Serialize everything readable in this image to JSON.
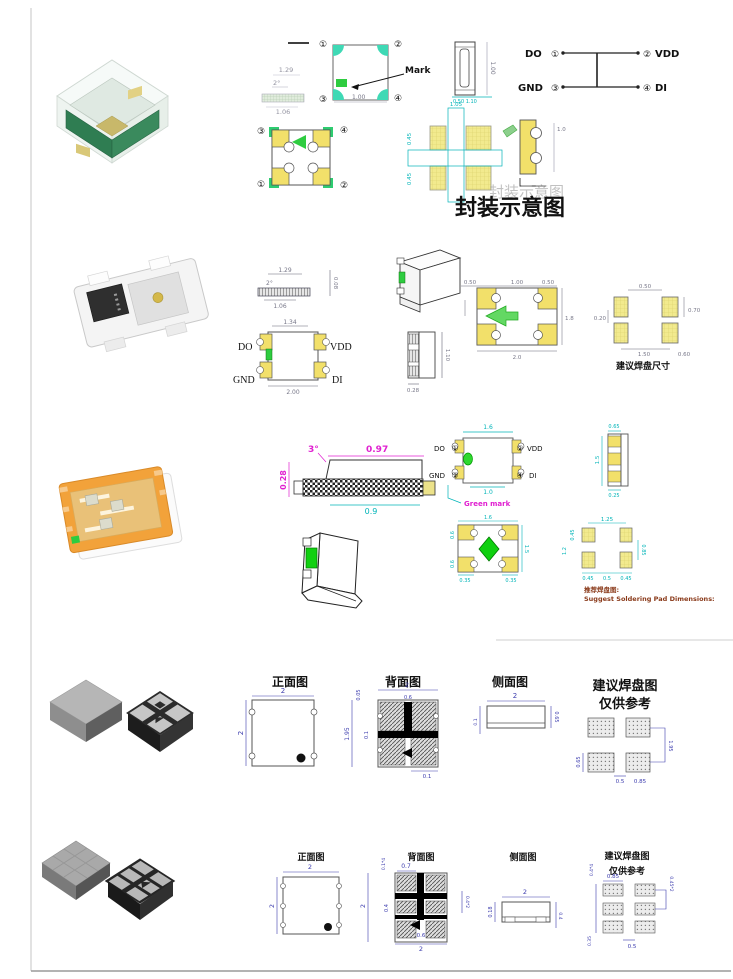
{
  "captions": {
    "package_schematic": "封装示意图",
    "suggested_pad_size": "建议焊盘尺寸",
    "recommend_pad_cn": "推荐焊盘图:",
    "recommend_pad_en": "Suggest Soldering Pad Dimensions:",
    "front_view": "正面图",
    "back_view": "背面图",
    "side_view": "侧面图",
    "pad_layout_title": "建议焊盘图",
    "reference_only": "仅供参考"
  },
  "colors": {
    "cyan_dim": "#00b4b8",
    "magenta_dim": "#e020d0",
    "navy_dim": "#3c3cae",
    "pad_yellow": "#f2ea8e",
    "mark_green": "#2ecc40"
  },
  "row1": {
    "profile": {
      "d1": "1.29",
      "d2": "2°",
      "d3": "1.06"
    },
    "top_view": {
      "n1": "①",
      "n2": "②",
      "n3": "③",
      "n4": "④",
      "mark": "Mark",
      "dim": "1.00"
    },
    "side_view": {
      "dim": "1.00",
      "dim2": "0.50 1.10"
    },
    "pinout": {
      "p1": "DO",
      "n1": "①",
      "p2": "VDD",
      "n2": "②",
      "p3": "GND",
      "n3": "③",
      "p4": "DI",
      "n4": "④"
    },
    "bottom_view": {
      "n1": "③",
      "n2": "④",
      "n3": "①",
      "n4": "②"
    },
    "pads": {
      "d1": "1.05",
      "d2": "0.45",
      "d3": "0.45"
    },
    "sketch": {
      "dim": "1.0"
    }
  },
  "row2": {
    "profile": {
      "d1": "1.29",
      "d2": "2°",
      "d3": "1.06",
      "d4": "0.08"
    },
    "outline": {
      "dim_top": "1.34",
      "dim_bottom": "2.00",
      "p1": "DO",
      "p2": "VDD",
      "p3": "GND",
      "p4": "DI"
    },
    "side": {
      "d1": "1.10",
      "d2": "0.28"
    },
    "bottom_view": {
      "d1": "0.50",
      "d2": "1.00",
      "d3": "0.50",
      "d4": "1.8",
      "d5": "2.0"
    },
    "pads": {
      "d1": "0.50",
      "d2": "0.70",
      "d3": "0.20",
      "d4": "1.50",
      "d5": "0.60"
    }
  },
  "row3": {
    "profile": {
      "d1": "3°",
      "d2": "0.97",
      "d3": "0.28",
      "d4": "0.9"
    },
    "pin_view": {
      "p1": "DO",
      "n1": "①",
      "p2": "VDD",
      "n2": "②",
      "p3": "GND",
      "n3": "③",
      "p4": "DI",
      "n4": "④",
      "dim_top": "1.6",
      "dim_bottom": "1.0",
      "green_mark": "Green mark"
    },
    "side": {
      "d1": "0.65",
      "d2": "1.5",
      "d3": "0.25"
    },
    "bottom_view": {
      "d1": "1.6",
      "d2": "0.6",
      "d3": "0.6",
      "d4": "1.5",
      "d5": "0.35",
      "d6": "0.35"
    },
    "pads": {
      "d1": "1.25",
      "d2": "0.45",
      "d3": "1.2",
      "d4": "0.85",
      "d5": "0.45",
      "d6": "0.5",
      "d7": "0.45"
    }
  },
  "row4": {
    "front": {
      "d1": "2",
      "d2": "2"
    },
    "back": {
      "d1": "0.05",
      "d2": "2",
      "d3": "0.6",
      "d4": "1.95",
      "d5": "0.1",
      "d6": "0.1"
    },
    "side": {
      "d1": "2",
      "d2": "0.65",
      "d3": "0.1"
    },
    "pads": {
      "d1": "0.65",
      "d2": "1.95",
      "d3": "0.5",
      "d4": "0.85"
    }
  },
  "row5": {
    "front": {
      "d1": "2",
      "d2": "2"
    },
    "back": {
      "d1": "0.1*4",
      "d2": "0.7",
      "d3": "2",
      "d4": "0.4",
      "d5": "0.6",
      "d6": "2",
      "d7": "0.4*2"
    },
    "side": {
      "d1": "2",
      "d2": "0.18",
      "d3": "0.4"
    },
    "pads": {
      "d1": "0.4*4",
      "d2": "0.85",
      "d3": "0.45*2",
      "d4": "0.35",
      "d5": "0.5"
    }
  }
}
